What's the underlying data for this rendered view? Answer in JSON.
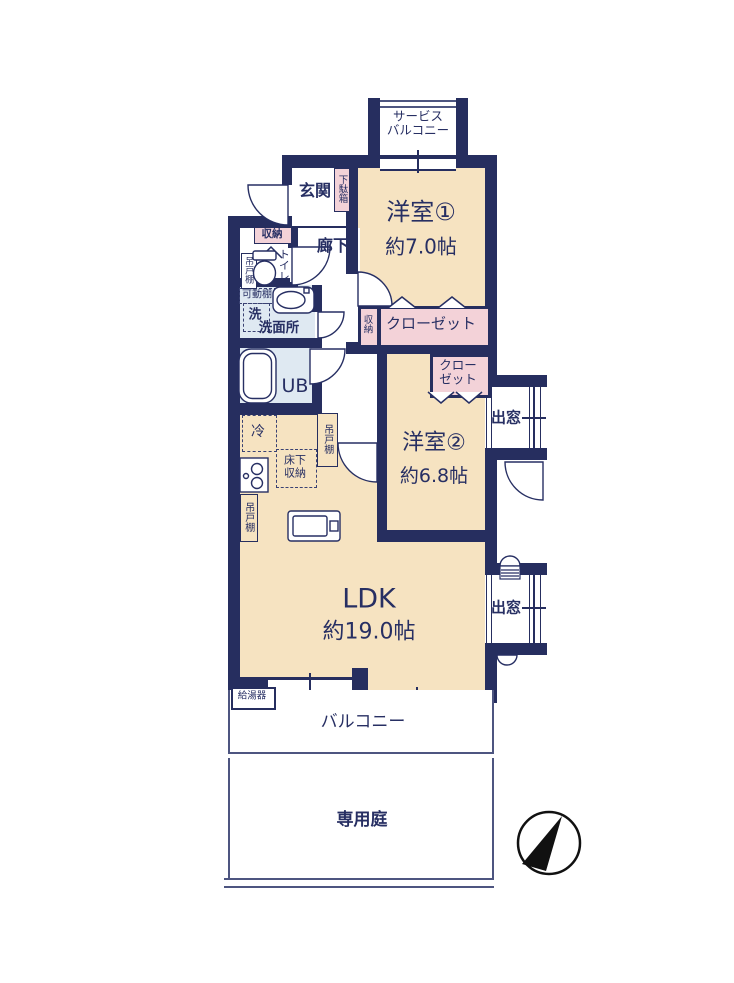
{
  "colors": {
    "wall": "#262e5f",
    "room_cream": "#f6e3c1",
    "closet_pink": "#f3d2d8",
    "wet_blue": "#dfe9f2",
    "text": "#272f63",
    "outdoor_line": "#4d5580"
  },
  "areas": {
    "service_balcony": {
      "line1": "サービス",
      "line2": "バルコニー"
    },
    "entrance": {
      "label": "玄関"
    },
    "shoe_cabinet": {
      "label": "下駄箱"
    },
    "entrance_storage": {
      "label": "収納"
    },
    "toilet": {
      "label": "トイレ"
    },
    "hanging_cabinet_toilet": {
      "label": "吊戸棚"
    },
    "movable_shelf": {
      "label": "可動棚"
    },
    "washer": {
      "label": "洗"
    },
    "washroom": {
      "label": "洗面所"
    },
    "corridor": {
      "label": "廊下"
    },
    "room1": {
      "name": "洋室①",
      "size": "約7.0帖"
    },
    "closet1": {
      "label": "クローゼット"
    },
    "corridor_storage": {
      "label": "収納"
    },
    "closet2": {
      "line1": "クロー",
      "line2": "ゼット"
    },
    "room2": {
      "name": "洋室②",
      "size": "約6.8帖"
    },
    "bay_window1": {
      "label": "出窓"
    },
    "bay_window2": {
      "label": "出窓"
    },
    "unit_bath": {
      "label": "UB"
    },
    "refrigerator": {
      "label": "冷"
    },
    "hanging_cabinet_kitchen": {
      "label": "吊戸棚"
    },
    "underfloor_storage": {
      "line1": "床下",
      "line2": "収納"
    },
    "hanging_cabinet_lower": {
      "label": "吊戸棚"
    },
    "ldk": {
      "name": "LDK",
      "size": "約19.0帖"
    },
    "water_heater": {
      "label": "給湯器"
    },
    "balcony": {
      "label": "バルコニー"
    },
    "private_garden": {
      "label": "専用庭"
    }
  }
}
